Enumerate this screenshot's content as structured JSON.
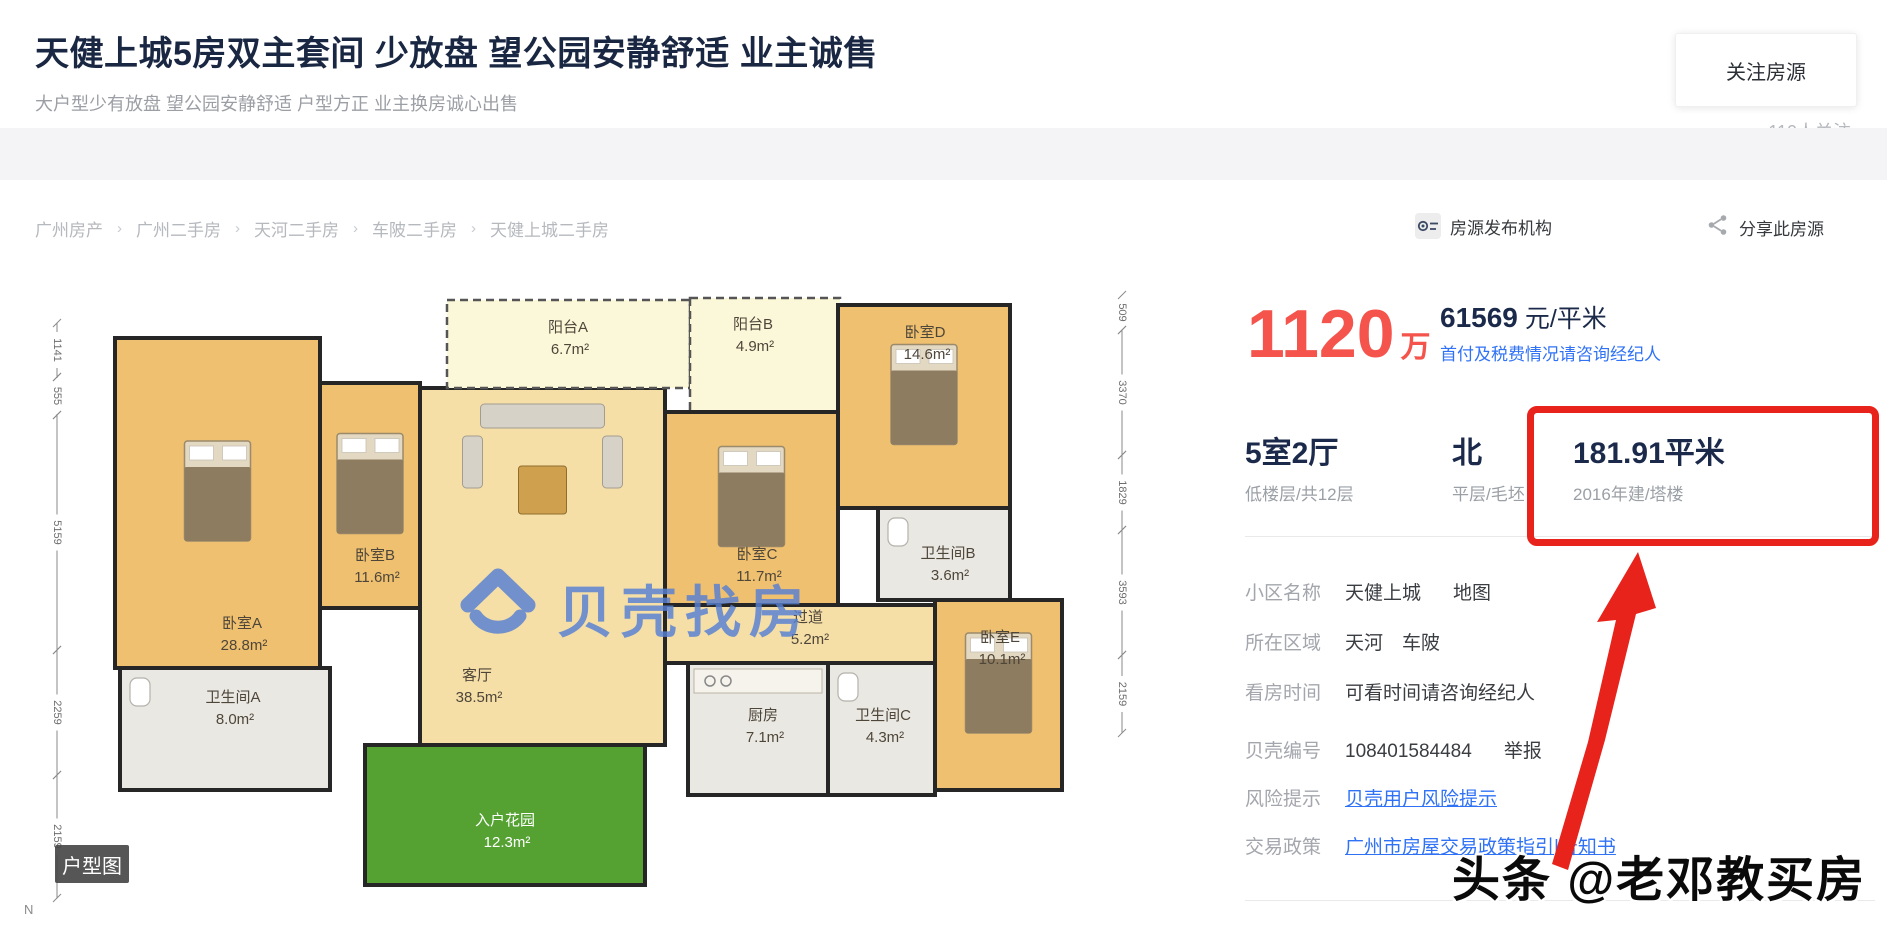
{
  "header": {
    "title": "天健上城5房双主套间 少放盘 望公园安静舒适 业主诚售",
    "subtitle": "大户型少有放盘 望公园安静舒适 户型方正 业主换房诚心出售",
    "follow_button": "关注房源",
    "follow_count": "110人关注"
  },
  "breadcrumb": {
    "separator": "›",
    "items": [
      "广州房产",
      "广州二手房",
      "天河二手房",
      "车陂二手房",
      "天健上城二手房"
    ]
  },
  "meta_bar": {
    "publisher": "房源发布机构",
    "share": "分享此房源"
  },
  "price": {
    "total": "1120",
    "total_unit": "万",
    "per_sqm": "61569",
    "per_sqm_unit": " 元/平米",
    "note": "首付及税费情况请咨询经纪人"
  },
  "summary": {
    "columns": [
      {
        "main": "5室2厅",
        "sub": "低楼层/共12层"
      },
      {
        "main": "北",
        "sub": "平层/毛坯"
      },
      {
        "main": "181.91平米",
        "sub": "2016年建/塔楼"
      }
    ]
  },
  "details": {
    "rows": [
      {
        "label": "小区名称",
        "value": "天健上城",
        "extra": "地图"
      },
      {
        "label": "所在区域",
        "value": "天河　车陂"
      },
      {
        "label": "看房时间",
        "value": "可看时间请咨询经纪人"
      },
      {
        "label": "贝壳编号",
        "value": "108401584484",
        "extra": "举报"
      },
      {
        "label": "风险提示",
        "value": "贝壳用户风险提示",
        "link": true
      },
      {
        "label": "交易政策",
        "value": "广州市房屋交易政策指引|告知书",
        "link": true
      }
    ]
  },
  "floorplan": {
    "badge": "户型图",
    "compass": "N",
    "watermark": "贝壳找房",
    "rooms": [
      {
        "name": "卧室A",
        "area": "28.8m²",
        "type": "bedroom",
        "x": 95,
        "y": 88,
        "w": 205,
        "h": 330,
        "lx": 222,
        "ly": 378
      },
      {
        "name": "卧室B",
        "area": "11.6m²",
        "type": "bedroom",
        "x": 300,
        "y": 133,
        "w": 100,
        "h": 225,
        "lx": 355,
        "ly": 310
      },
      {
        "name": "客厅",
        "area": "38.5m²",
        "type": "living",
        "x": 400,
        "y": 138,
        "w": 245,
        "h": 357,
        "lx": 457,
        "ly": 430
      },
      {
        "name": "阳台A",
        "area": "6.7m²",
        "type": "balcony",
        "x": 427,
        "y": 50,
        "w": 243,
        "h": 88,
        "lx": 548,
        "ly": 82
      },
      {
        "name": "阳台B",
        "area": "4.9m²",
        "type": "balcony",
        "x": 670,
        "y": 48,
        "w": 150,
        "h": 114,
        "lx": 733,
        "ly": 79
      },
      {
        "name": "卧室D",
        "area": "14.6m²",
        "type": "bedroom",
        "x": 818,
        "y": 55,
        "w": 172,
        "h": 203,
        "lx": 905,
        "ly": 87
      },
      {
        "name": "卧室C",
        "area": "11.7m²",
        "type": "bedroom",
        "x": 645,
        "y": 162,
        "w": 173,
        "h": 193,
        "lx": 737,
        "ly": 309
      },
      {
        "name": "卫生间B",
        "area": "3.6m²",
        "type": "bath",
        "x": 858,
        "y": 258,
        "w": 132,
        "h": 92,
        "lx": 928,
        "ly": 308
      },
      {
        "name": "过道",
        "area": "5.2m²",
        "type": "hall",
        "x": 645,
        "y": 355,
        "w": 290,
        "h": 58,
        "lx": 788,
        "ly": 372
      },
      {
        "name": "厨房",
        "area": "7.1m²",
        "type": "kitchen",
        "x": 668,
        "y": 413,
        "w": 140,
        "h": 132,
        "lx": 743,
        "ly": 470
      },
      {
        "name": "卫生间C",
        "area": "4.3m²",
        "type": "bath",
        "x": 808,
        "y": 413,
        "w": 107,
        "h": 132,
        "lx": 863,
        "ly": 470
      },
      {
        "name": "卧室E",
        "area": "10.1m²",
        "type": "bedroom",
        "x": 915,
        "y": 350,
        "w": 127,
        "h": 190,
        "lx": 980,
        "ly": 392
      },
      {
        "name": "卫生间A",
        "area": "8.0m²",
        "type": "bath",
        "x": 100,
        "y": 418,
        "w": 210,
        "h": 122,
        "lx": 213,
        "ly": 452
      },
      {
        "name": "入户花园",
        "area": "12.3m²",
        "type": "garden",
        "x": 345,
        "y": 495,
        "w": 280,
        "h": 140,
        "lx": 485,
        "ly": 575
      }
    ],
    "dims_left": {
      "x": 37,
      "segments": [
        {
          "label": "1141",
          "from": 73,
          "to": 127
        },
        {
          "label": "555",
          "from": 127,
          "to": 165
        },
        {
          "label": "5159",
          "from": 165,
          "to": 400
        },
        {
          "label": "2259",
          "from": 400,
          "to": 525
        },
        {
          "label": "2159",
          "from": 525,
          "to": 648
        }
      ]
    },
    "dims_right": {
      "x": 1102,
      "segments": [
        {
          "label": "509",
          "from": 45,
          "to": 80
        },
        {
          "label": "3370",
          "from": 80,
          "to": 205
        },
        {
          "label": "1829",
          "from": 205,
          "to": 280
        },
        {
          "label": "3593",
          "from": 280,
          "to": 405
        },
        {
          "label": "2159",
          "from": 405,
          "to": 483
        }
      ]
    }
  },
  "annotations": {
    "photo_watermark": "头条 @老邓教买房"
  },
  "colors": {
    "accent_red": "#e7231b",
    "price_red": "#f4544b",
    "link_blue": "#3072f6",
    "navy": "#1b2a4a",
    "beike_blue": "#567fd4",
    "wall": "#262626",
    "wood": "#eec06f",
    "sand": "#f5dfa7",
    "pale": "#fbf8da",
    "gray_room": "#eae8e3",
    "garden_green": "#55a233"
  }
}
